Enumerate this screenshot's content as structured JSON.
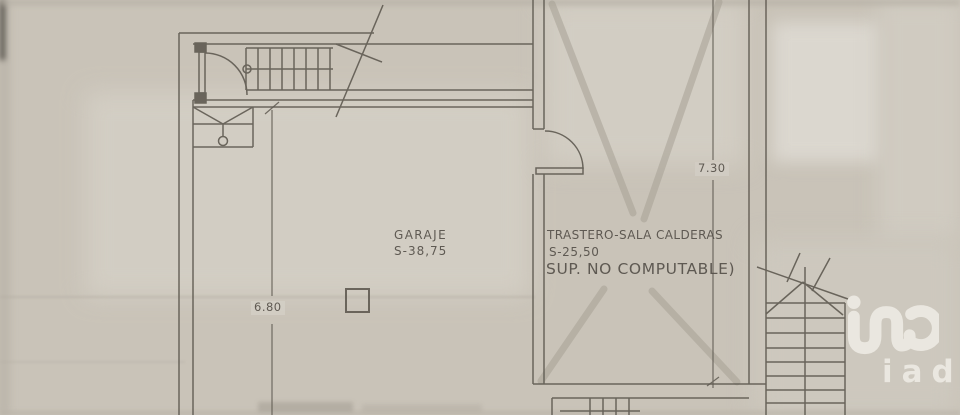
{
  "plan": {
    "rooms": [
      {
        "name": "GARAJE",
        "area": "S-38,75"
      },
      {
        "name": "TRASTERO-SALA CALDERAS",
        "area": "S-25,50",
        "note": "SUP. NO COMPUTABLE)"
      }
    ],
    "dimensions": [
      {
        "axis": "vertical-right-of-trastero",
        "value": "7.30"
      },
      {
        "axis": "vertical-in-garage",
        "value": "6.80"
      }
    ]
  },
  "watermark": {
    "text": "iad"
  },
  "colors": {
    "paper": "#c9c3b8",
    "ink": "#5f5a51",
    "pencil_mark": "#a7a195",
    "watermark": "#ece9e2"
  }
}
